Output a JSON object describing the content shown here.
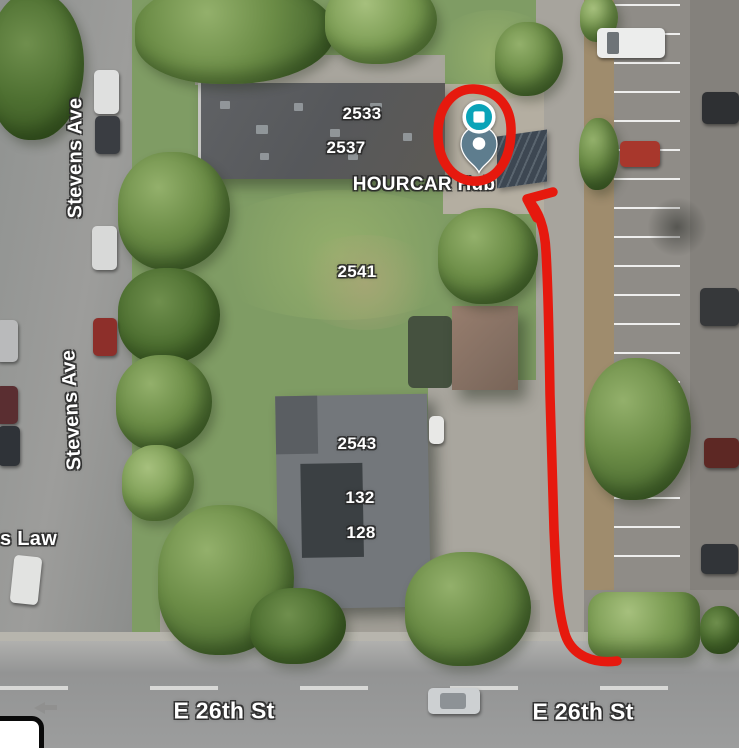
{
  "map": {
    "view_type": "satellite",
    "labels": {
      "streets": {
        "stevens_ave": "Stevens Ave",
        "e_26th_st": "E 26th St"
      },
      "addresses": {
        "n2533": "2533",
        "n2537": "2537",
        "n2541": "2541",
        "n2543": "2543",
        "n132": "132",
        "n128": "128"
      },
      "pois": {
        "hourcar_hub": "HOURCAR Hub",
        "law_partial": "s Law"
      }
    },
    "markers": {
      "hub": {
        "name": "hourcar-hub-marker",
        "glyph": "square",
        "color": "#0aa3b8",
        "ring": "#ffffff"
      },
      "pin": {
        "name": "dropped-pin-marker",
        "glyph": "circle",
        "color": "#5e7d8e",
        "hole": "#ffffff"
      }
    },
    "annotation": {
      "color": "#e6190e",
      "shapes": [
        "circle-around-markers",
        "arrow-from-e-26th-st-up-alley-to-markers"
      ]
    }
  }
}
